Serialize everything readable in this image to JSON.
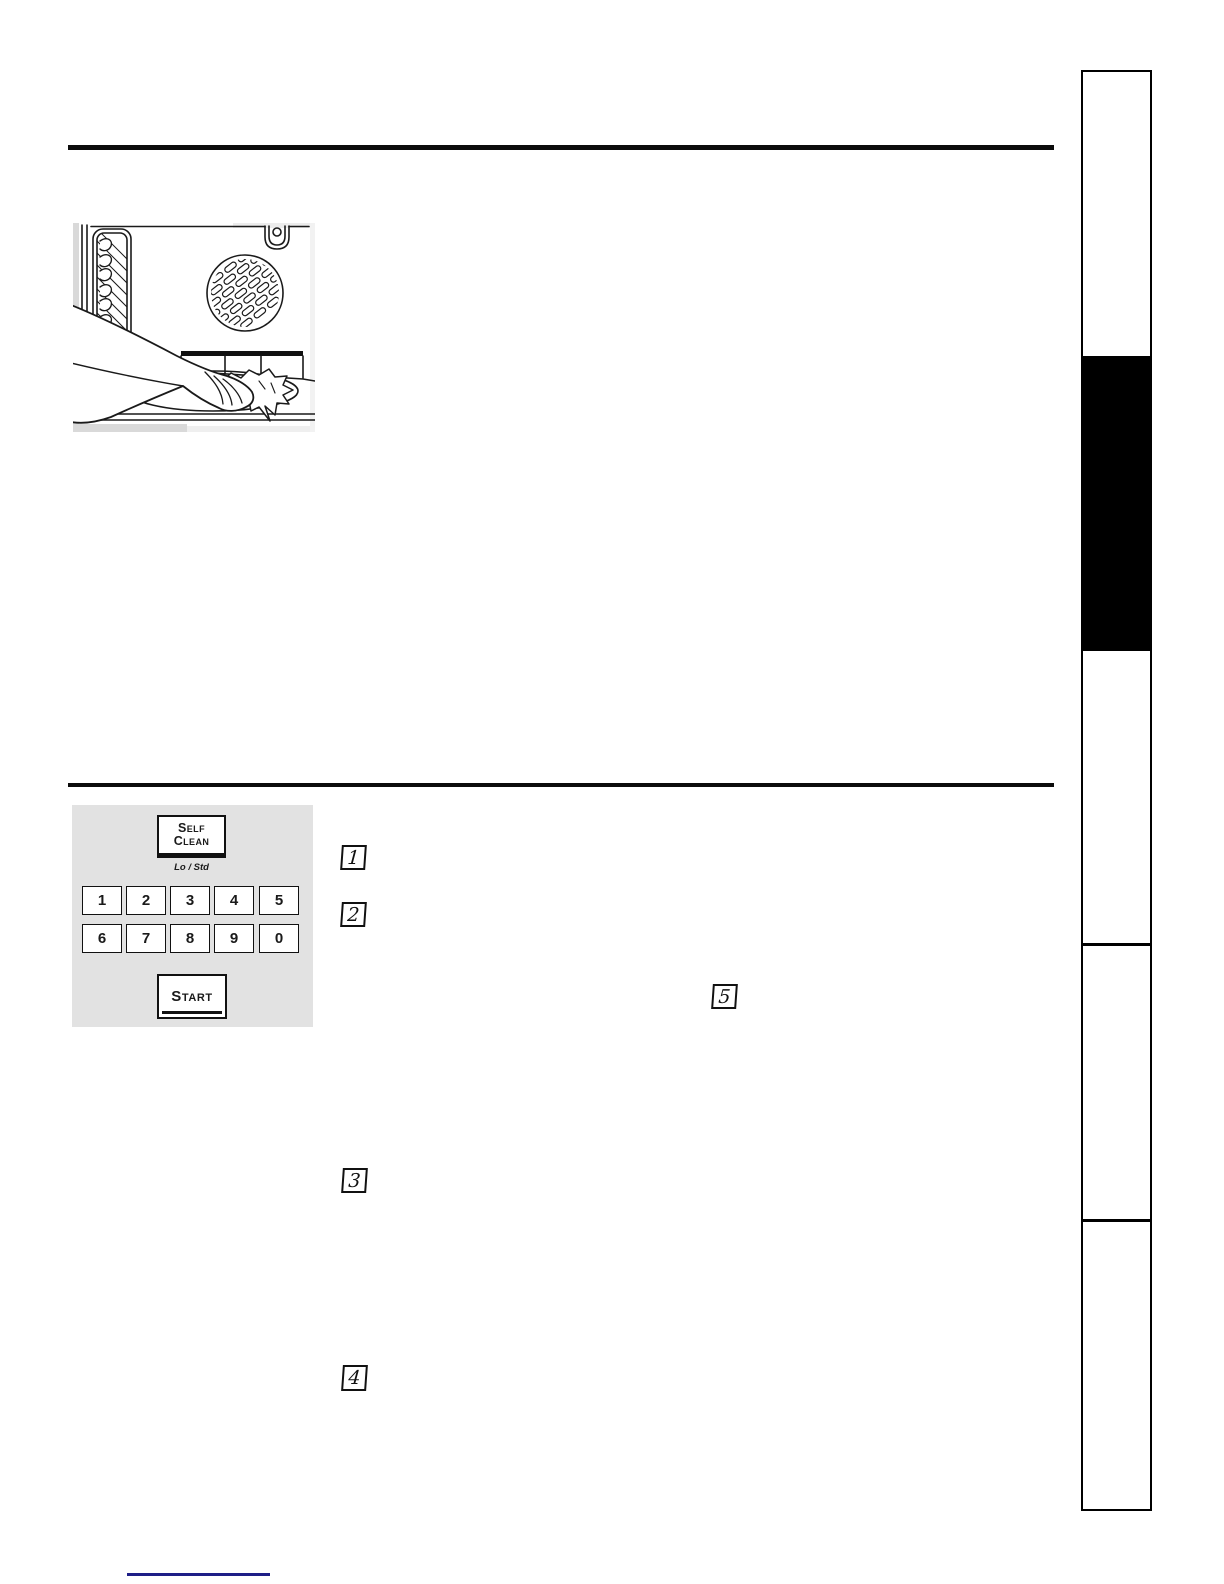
{
  "document": {
    "kind": "appliance manual page (self-clean instructions)",
    "figure": {
      "name": "hand-wiping-oven-interior",
      "alt": "Hand wiping the oven floor with a cloth"
    }
  },
  "control_panel": {
    "self_clean": {
      "label": "Self Clean",
      "sub_label": "Lo / Std"
    },
    "keypad": [
      "1",
      "2",
      "3",
      "4",
      "5",
      "6",
      "7",
      "8",
      "9",
      "0"
    ],
    "start": {
      "label": "Start"
    }
  },
  "steps": {
    "step1": "1",
    "step2": "2",
    "step3": "3",
    "step4": "4",
    "step5": "5"
  },
  "colors": {
    "panel_background": "#e2e2e2",
    "rule": "#0c0c0c",
    "sidebar_black_tab": "#000000",
    "footer_link_underline": "#1e1e87",
    "figure_matte": "#d9d9d9"
  }
}
